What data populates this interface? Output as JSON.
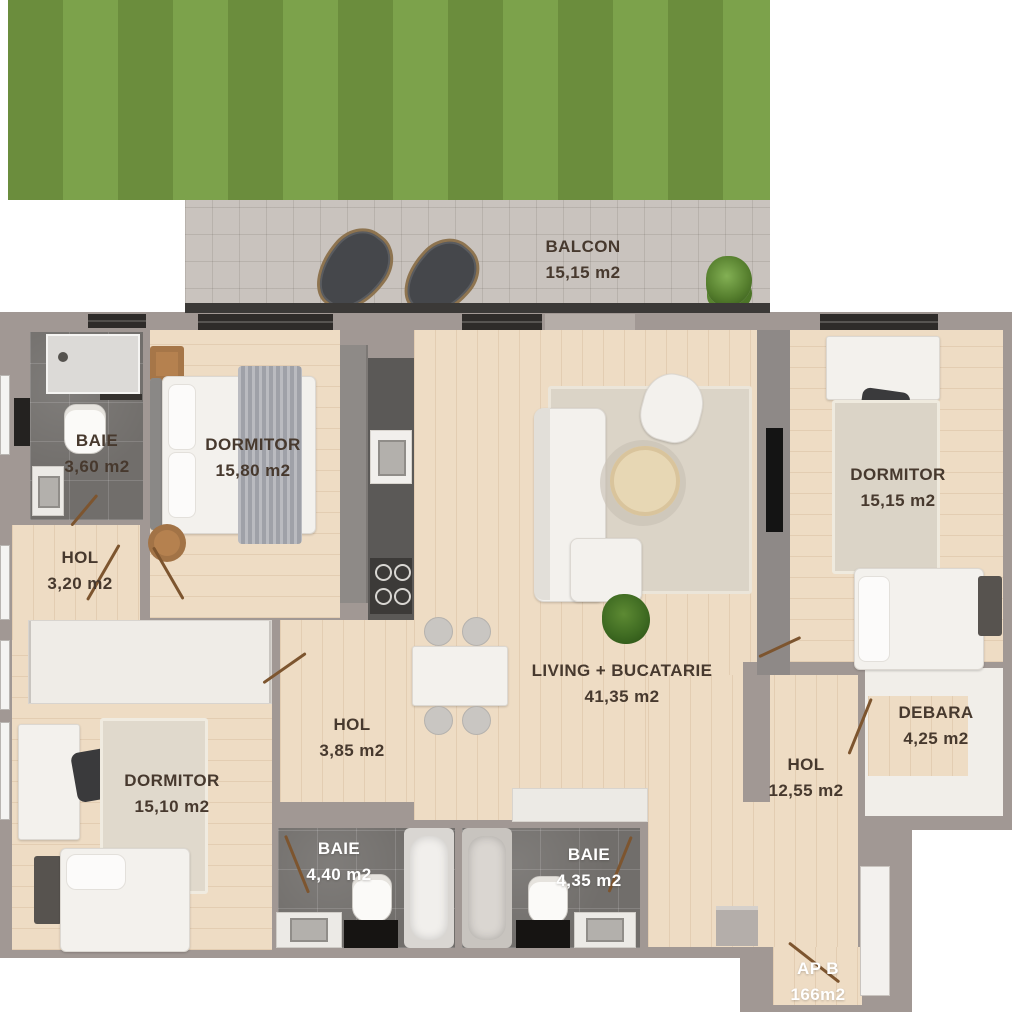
{
  "apartment": {
    "label": "AP B",
    "total_area": "166m2"
  },
  "rooms": {
    "balcon": {
      "name": "BALCON",
      "area": "15,15 m2"
    },
    "baie_1": {
      "name": "BAIE",
      "area": "3,60 m2"
    },
    "dormitor_1": {
      "name": "DORMITOR",
      "area": "15,80 m2"
    },
    "hol_1": {
      "name": "HOL",
      "area": "3,20 m2"
    },
    "dormitor_2": {
      "name": "DORMITOR",
      "area": "15,15 m2"
    },
    "living": {
      "name": "LIVING + BUCATARIE",
      "area": "41,35 m2"
    },
    "hol_2": {
      "name": "HOL",
      "area": "3,85 m2"
    },
    "dormitor_3": {
      "name": "DORMITOR",
      "area": "15,10 m2"
    },
    "baie_2": {
      "name": "BAIE",
      "area": "4,40 m2"
    },
    "baie_3": {
      "name": "BAIE",
      "area": "4,35 m2"
    },
    "hol_3": {
      "name": "HOL",
      "area": "12,55 m2"
    },
    "debara": {
      "name": "DEBARA",
      "area": "4,25 m2"
    }
  },
  "colors": {
    "grass_dark": "#6b8d3d",
    "grass_light": "#7ca24b",
    "balcony_tile": "#c9c3be",
    "wall": "#a19894",
    "wood_floor": "#eedcc4",
    "bath_tile": "#716e6b",
    "label_dark": "#47392e",
    "label_light": "#ffffff"
  }
}
